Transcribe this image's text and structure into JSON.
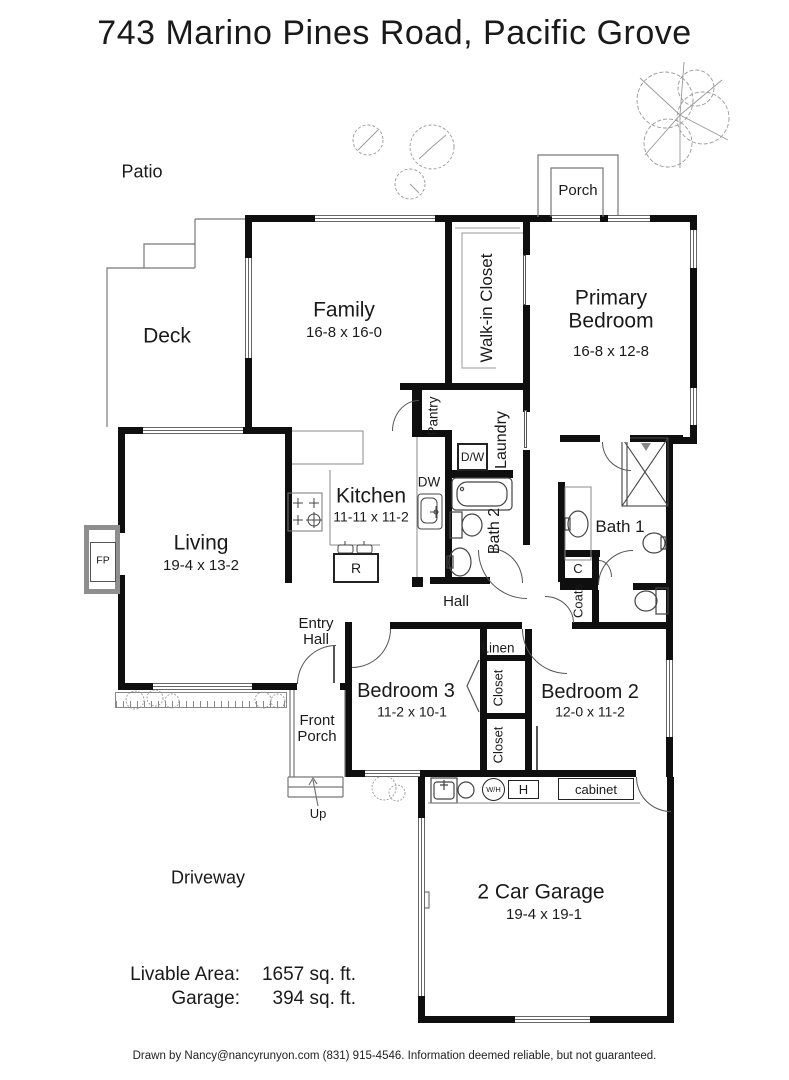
{
  "title": "743 Marino Pines Road, Pacific Grove",
  "colors": {
    "wall": "#0f0f0f",
    "line": "#777777",
    "fixture": "#333333"
  },
  "outdoor": {
    "patio": "Patio",
    "deck": "Deck",
    "porch": "Porch",
    "front_porch": "Front Porch",
    "driveway": "Driveway",
    "up": "Up"
  },
  "rooms": {
    "family": {
      "label": "Family",
      "dims": "16-8 x 16-0"
    },
    "primary": {
      "label": "Primary Bedroom",
      "dims": "16-8 x 12-8"
    },
    "kitchen": {
      "label": "Kitchen",
      "dims": "11-11 x 11-2"
    },
    "living": {
      "label": "Living",
      "dims": "19-4 x 13-2"
    },
    "bedroom3": {
      "label": "Bedroom 3",
      "dims": "11-2 x 10-1"
    },
    "bedroom2": {
      "label": "Bedroom 2",
      "dims": "12-0 x 11-2"
    },
    "garage": {
      "label": "2 Car Garage",
      "dims": "19-4 x 19-1"
    }
  },
  "baths": {
    "bath1": "Bath 1",
    "bath2": "Bath 2"
  },
  "storage": {
    "walk_in_closet": "Walk-in Closet",
    "pantry": "Pantry",
    "laundry": "Laundry",
    "linen": "Linen",
    "closet_bedroom3": "Closet",
    "closet_bedroom2": "Closet",
    "coats": "Coats",
    "c_closet": "C",
    "cabinet": "cabinet"
  },
  "circulation": {
    "hall": "Hall",
    "entry_hall": "Entry Hall"
  },
  "appliances": {
    "dishwasher": "DW",
    "washer_dryer": "D/W",
    "range": "R",
    "water_heater": "W/H",
    "heater": "H",
    "fireplace": "FP"
  },
  "summary": {
    "livable_label": "Livable Area:",
    "livable_value": "1657 sq. ft.",
    "garage_label": "Garage:",
    "garage_value": "394 sq. ft."
  },
  "footer": "Drawn by Nancy@nancyrunyon.com (831) 915-4546.  Information deemed reliable, but not guaranteed."
}
